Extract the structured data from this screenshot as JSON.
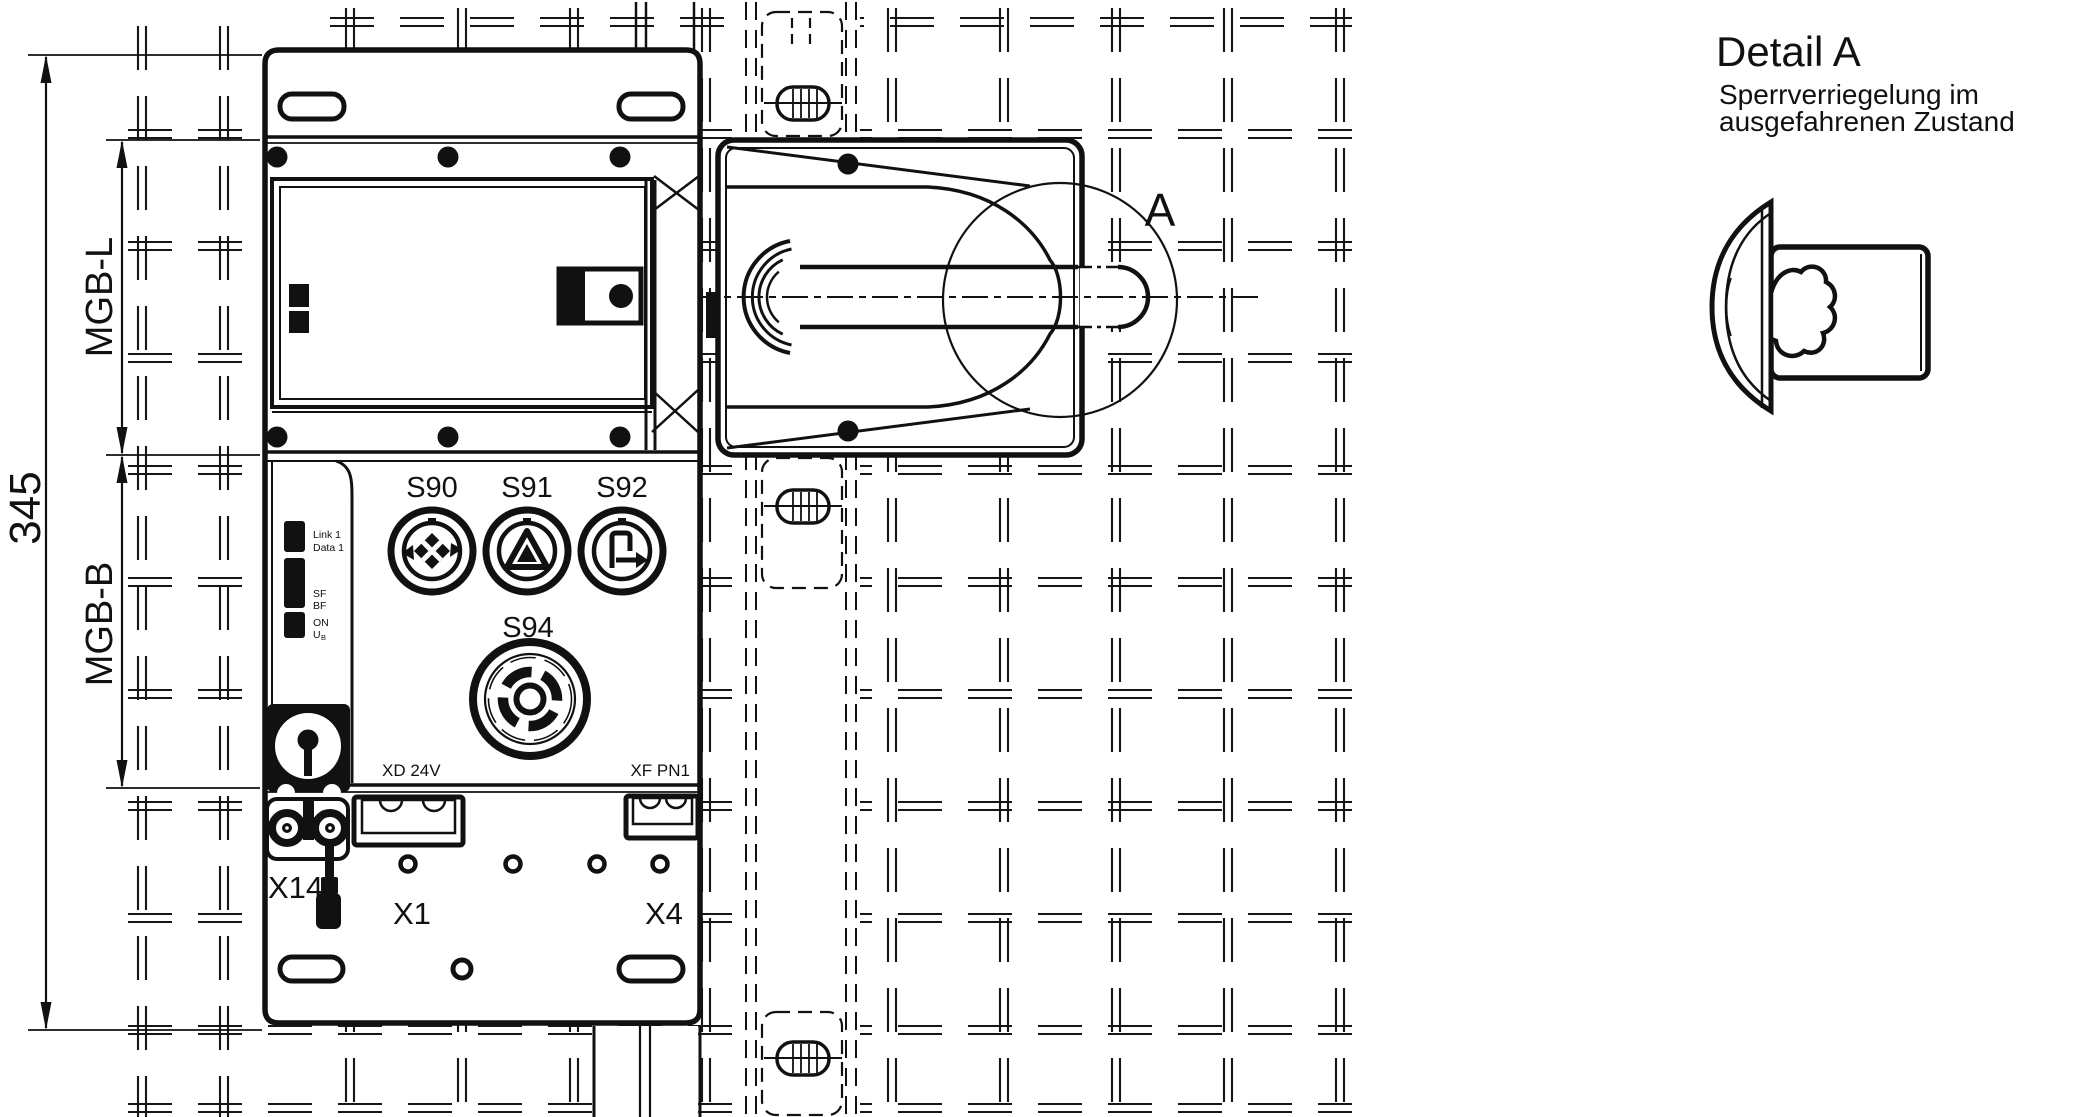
{
  "drawing": {
    "dimensions": {
      "overall_height": "345",
      "lock_module": "MGB-L",
      "bus_module": "MGB-B"
    },
    "controls": {
      "s90": "S90",
      "s91": "S91",
      "s92": "S92",
      "s94": "S94"
    },
    "status_leds": {
      "link": "Link 1",
      "data": "Data 1",
      "sf": "SF",
      "bf": "BF",
      "on": "ON",
      "ub_main": "U",
      "ub_sub": "B"
    },
    "connectors": {
      "power": "XD 24V",
      "profinet": "XF PN1",
      "x14": "X14",
      "x1": "X1",
      "x4": "X4"
    },
    "detail_view": {
      "title": "Detail A",
      "subtitle_line1": "Sperrverriegelung im",
      "subtitle_line2": "ausgefahrenen Zustand",
      "marker": "A"
    }
  },
  "colors": {
    "line": "#111111",
    "background": "#ffffff"
  }
}
